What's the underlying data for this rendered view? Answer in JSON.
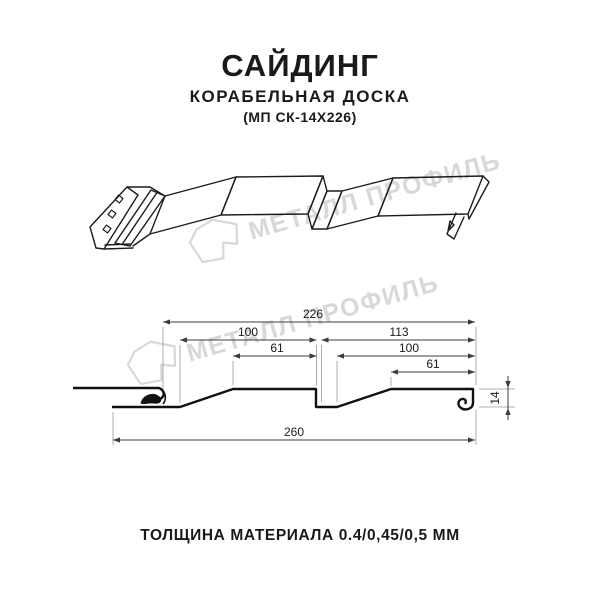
{
  "header": {
    "title": "САЙДИНГ",
    "subtitle": "КОРАБЕЛЬНАЯ ДОСКА",
    "model": "(МП СК-14Х226)"
  },
  "watermark": {
    "text": "МЕТАЛЛ ПРОФИЛЬ",
    "color": "#d8d8d8"
  },
  "section": {
    "dims": {
      "overall_top": "226",
      "left_pitch": "100",
      "right_pitch": "113",
      "left_flat": "61",
      "right_inner": "100",
      "right_flat": "61",
      "overall_bottom": "260",
      "profile_height": "14"
    }
  },
  "footer": {
    "thickness": "ТОЛЩИНА МАТЕРИАЛА 0.4/0,45/0,5 ММ"
  },
  "colors": {
    "line": "#1c1c1c",
    "dimension": "#3c3c3c",
    "extension": "#999999",
    "watermark": "#d8d8d8",
    "background": "#ffffff"
  }
}
